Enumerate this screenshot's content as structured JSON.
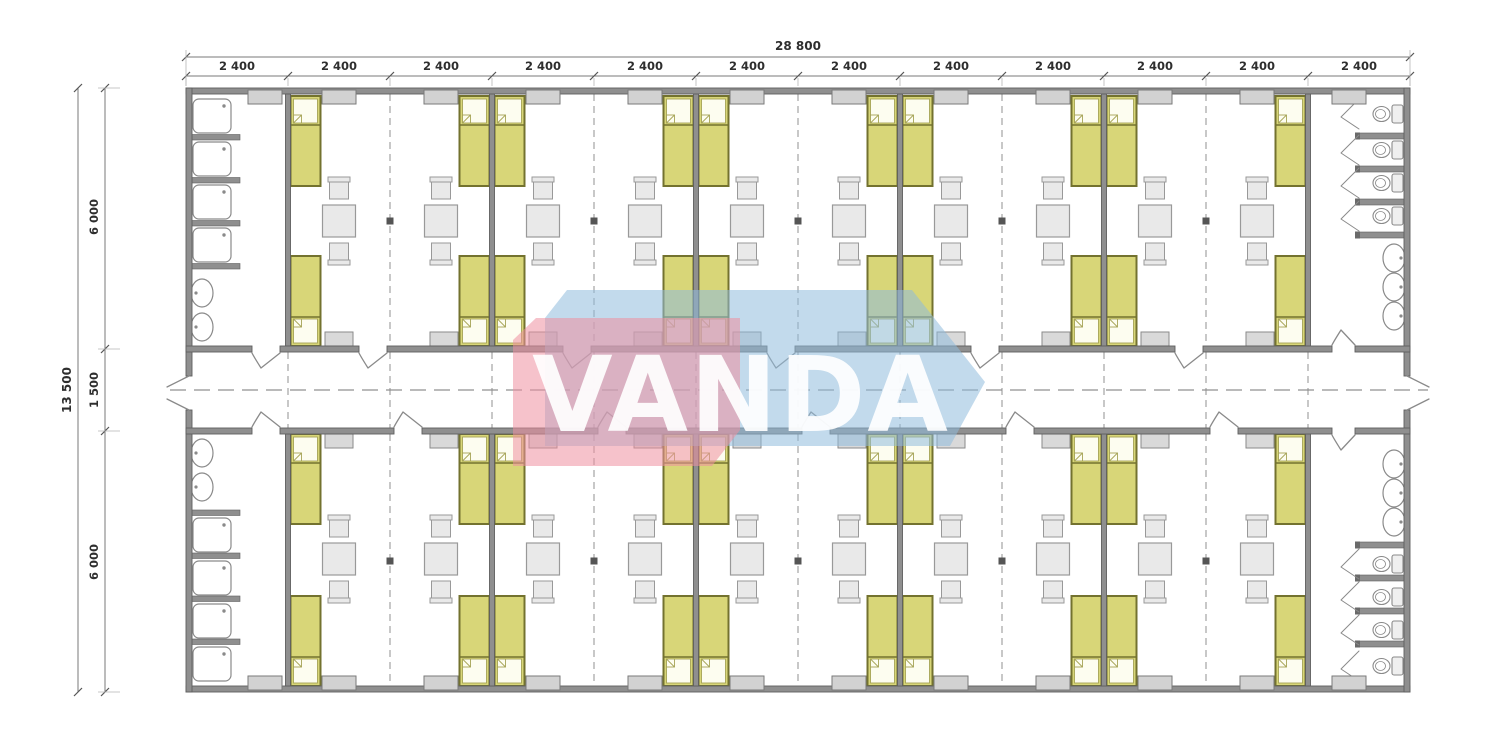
{
  "dimensions": {
    "top_total": "28 800",
    "top_segments": [
      "2 400",
      "2 400",
      "2 400",
      "2 400",
      "2 400",
      "2 400",
      "2 400",
      "2 400",
      "2 400",
      "2 400",
      "2 400",
      "2 400"
    ],
    "left_total": "13 500",
    "left_segments": [
      "6 000",
      "1 500",
      "6 000"
    ]
  },
  "watermark": {
    "text": "VANDA",
    "red": "#ef8fa0",
    "blue": "#8fbbdd",
    "text_color": "#ffffff"
  },
  "plan": {
    "modules": 12,
    "rows": 2,
    "rooms_per_row": 5,
    "inventory": {
      "beds_per_room": 4,
      "tables_per_room": 2,
      "chairs_per_table": 2,
      "wardrobes_per_room": 2,
      "showers_per_shower_room": 4,
      "toilets_per_toilet_room": 4,
      "sinks_shower_room": 2,
      "sinks_toilet_room": 3
    },
    "colors": {
      "wall": "#8f8f8f",
      "wall_edge": "#5f5f5f",
      "bed": "#d8d678",
      "bed_border": "#73722f",
      "pillow": "#fdfdf0",
      "pillow_border": "#a6a456",
      "furniture": "#e9e9e9",
      "furniture_border": "#999999",
      "wardrobe": "#d9d9d9",
      "window": "#d2d2d2",
      "window_border": "#7a7a7a",
      "fixture": "#ffffff",
      "fixture_border": "#8a8a8a",
      "dash": "#9a9a9a",
      "centerline": "#909090",
      "dim_line": "#7a7a7a",
      "dim_text": "#2e2e2e",
      "joint_marker": "#555555"
    }
  }
}
